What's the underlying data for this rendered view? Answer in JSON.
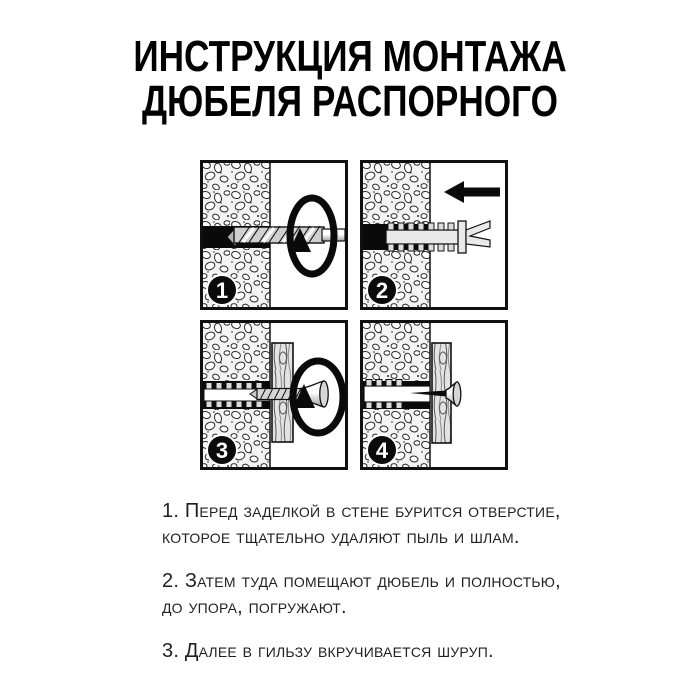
{
  "title": {
    "line1": "ИНСТРУКЦИЯ МОНТАЖА",
    "line2": "ДЮБЕЛЯ РАСПОРНОГО"
  },
  "panels": [
    {
      "number": "1"
    },
    {
      "number": "2"
    },
    {
      "number": "3"
    },
    {
      "number": "4"
    }
  ],
  "instructions": [
    {
      "line1": "1. Перед заделкой в стене бурится отверстие,",
      "line2": "которое тщательно удаляют пыль и шлам."
    },
    {
      "line1": "2. Затем туда помещают дюбель и полностью,",
      "line2": "до упора, погружают."
    },
    {
      "line1": "3. Далее в гильзу вкручивается шуруп."
    }
  ],
  "colors": {
    "background": "#ffffff",
    "ink": "#111111",
    "text": "#1f1f1f",
    "metal_light": "#e9e9e9",
    "metal_mid": "#c9c9c9",
    "wood": "#e3e3e3"
  }
}
